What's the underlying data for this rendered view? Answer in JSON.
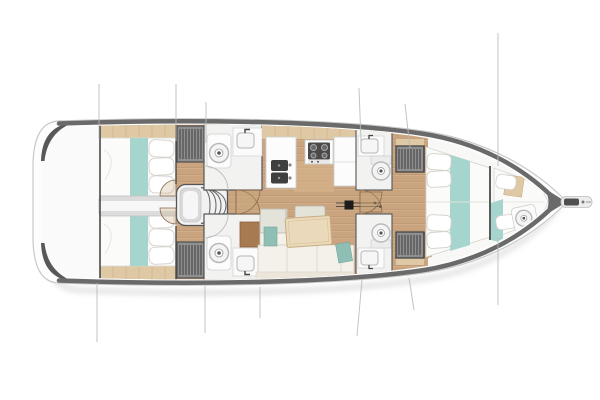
{
  "diagram": {
    "type": "yacht-interior-floor-plan",
    "view": "top-down",
    "orientation": "bow-right",
    "regions": [
      "transom-swim-area",
      "aft-cabin-port",
      "aft-cabin-starboard",
      "aft-corridor",
      "companionway-steps",
      "wardrobe-aft-port",
      "wardrobe-aft-starboard",
      "head-aft-port",
      "head-aft-starboard",
      "galley",
      "salon-seating",
      "salon-table",
      "mast",
      "head-mid-port",
      "head-mid-starboard",
      "owner-cabin",
      "wardrobe-fwd-port",
      "wardrobe-fwd-starboard",
      "forepeak-crew-cabin",
      "bow-sprit",
      "rigging-shroud-lines"
    ],
    "fixture_icons": [
      "toilet-icon",
      "sink-icon",
      "faucet-icon",
      "stove-burner-icon",
      "hanger-stripes-icon",
      "door-swing-arc",
      "step-treads-icon"
    ]
  },
  "colors": {
    "background": "#ffffff",
    "hull_fill": "#fdfdfd",
    "hull_outline": "#c8c8c8",
    "sheer_band": "#6a6a6a",
    "stern_trim": "#585858",
    "wood_floor": "#c9a47e",
    "wood_trim": "#dfc8a4",
    "bedding_white": "#fbfbfa",
    "teal_accent": "#a5d5cd",
    "sofa_cream": "#f3f1ea",
    "sofa_sage": "#8fbfb4",
    "bench_gray": "#e4e3da",
    "table_tan": "#ead9ba",
    "brown_table": "#a87a52",
    "wardrobe_gray": "#8f8f8f",
    "fixture_dark": "#3f3f3f",
    "room_white": "#f2f2f1",
    "corridor_gray": "#dcdcdc",
    "rigging_gray": "#b9b9b9",
    "mast_black": "#1c1c1c",
    "shadow": "#d4d4d4"
  }
}
